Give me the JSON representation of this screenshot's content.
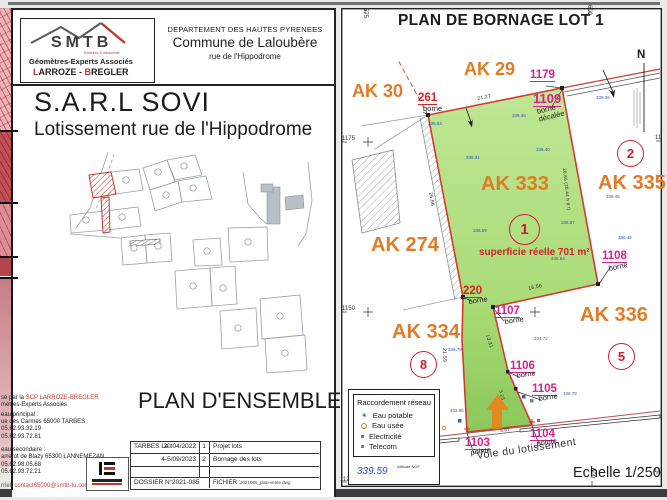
{
  "left_page": {
    "logo": {
      "name": "SMTB",
      "tagline": "Territoires & Urbanisme",
      "line1": "Géomètres-Experts Associés",
      "line2a": "L",
      "line2b": "ARROZE - ",
      "line2c": "B",
      "line2d": "REGLER"
    },
    "header": {
      "line1": "DEPARTEMENT DES HAUTES PYRENEES",
      "line2": "Commune de Laloubère",
      "line3": "rue de l'Hippodrome"
    },
    "title_company": "S.A.R.L SOVI",
    "title_project": "Lotissement rue de l'Hippodrome",
    "plan_title": "PLAN D'ENSEMBLE",
    "contact": {
      "l1_prefix": "sé par la ",
      "l1_red": "SCP LARROZE-BREGLER",
      "l2": "métres-Experts Associés",
      "l3": "eau principal :",
      "l4": "ue des Carmes 65000 TARBES",
      "l5": "05.62.93.32.19",
      "l6": "05.62.93.72.81",
      "l7": "eau secondaire :",
      "l8": "arrerot de Blazy 65300 LANNEMEZAN",
      "l9": "05.62.98.05.68",
      "l10": "05.62.93.72.21",
      "l11_prefix": "rriel: ",
      "l11_link": "contact65000@smtb-tu.com"
    },
    "table": {
      "city_label": "TARBES  Le :",
      "rows": [
        {
          "date": "20/04/2022",
          "num": "1",
          "label": "Projet lots"
        },
        {
          "date": "4-5/09/2023",
          "num": "2",
          "label": "Bornage des lots"
        }
      ],
      "dossier_label": "DOSSIER N°",
      "dossier_value": "2021-085",
      "fichier_label": "FICHIER :",
      "fichier_value": "2021085_plan-vente.dwg"
    }
  },
  "right_page": {
    "title": "PLAN DE BORNAGE LOT 1",
    "north": "N",
    "scale": "Echelle 1/250",
    "road": "Voie du lotissement",
    "area": "superficie réelle 701 m²",
    "parcels": [
      {
        "label": "AK 30"
      },
      {
        "label": "AK 29"
      },
      {
        "label": "AK 333"
      },
      {
        "label": "AK 335"
      },
      {
        "label": "AK 274"
      },
      {
        "label": "AK 334"
      },
      {
        "label": "AK 336"
      }
    ],
    "lots": [
      {
        "num": "1"
      },
      {
        "num": "2"
      },
      {
        "num": "8"
      },
      {
        "num": "5"
      }
    ],
    "points": [
      {
        "num": "1179",
        "sub": ""
      },
      {
        "num": "261",
        "sub": "borne"
      },
      {
        "num": "1109",
        "sub": "borne décalée"
      },
      {
        "num": "1108",
        "sub": "borne"
      },
      {
        "num": "220",
        "sub": "borne"
      },
      {
        "num": "1107",
        "sub": "borne"
      },
      {
        "num": "1106",
        "sub": "borne"
      },
      {
        "num": "1105",
        "sub": "borne"
      },
      {
        "num": "1104",
        "sub": "pointe"
      },
      {
        "num": "1103",
        "sub": "pointe"
      }
    ],
    "dims": [
      {
        "v": "21.27"
      },
      {
        "v": "26.66"
      },
      {
        "v": "20.86 (20.44 h 8 t)"
      },
      {
        "v": "16.56"
      },
      {
        "v": "21.59"
      },
      {
        "v": "13.31"
      },
      {
        "v": "5.23"
      },
      {
        "v": "5.07"
      }
    ],
    "grid": {
      "y": [
        {
          "v": "1175"
        },
        {
          "v": "1150"
        },
        {
          "v": "1125"
        }
      ],
      "x_top": [
        {
          "v": "575"
        },
        {
          "v": "600"
        }
      ],
      "x_bottom": "600",
      "frag": "11"
    },
    "elev": [
      {
        "v": "338.83"
      },
      {
        "v": "338.48"
      },
      {
        "v": "338.31"
      },
      {
        "v": "338.40"
      },
      {
        "v": "339.36"
      },
      {
        "v": "338.45"
      },
      {
        "v": "338.87"
      },
      {
        "v": "338.59"
      },
      {
        "v": "338.64"
      },
      {
        "v": "338.42"
      },
      {
        "v": "334.72"
      },
      {
        "v": "336.78"
      },
      {
        "v": "336.79"
      },
      {
        "v": "333.96"
      }
    ],
    "legend": {
      "title": "Raccordement réseau",
      "items": [
        {
          "label": "Eau potable"
        },
        {
          "label": "Eau usée"
        },
        {
          "label": "Electricité"
        },
        {
          "label": "Telecom"
        }
      ],
      "altitude_value": "339.59",
      "altitude_label": "Altitude NGF"
    }
  }
}
